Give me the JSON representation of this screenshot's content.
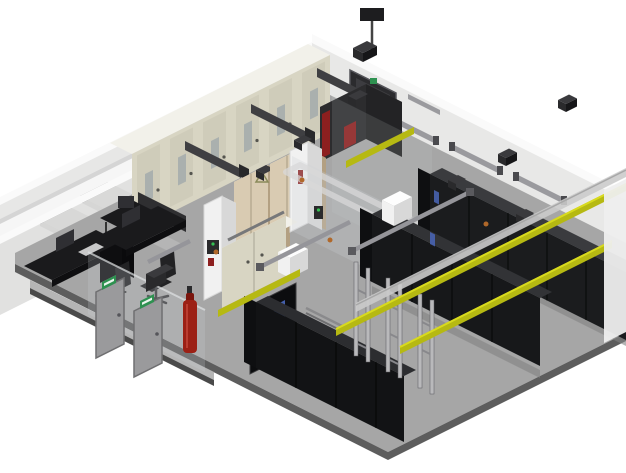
{
  "scene": {
    "type": "isometric-3d-render",
    "subject": "data-center-room-cutaway",
    "rooms": [
      "electrical-office-room",
      "server-hall"
    ]
  },
  "objects": {
    "electrical_cabinets": 6,
    "busbar_ducts": 4,
    "ups_units": 2,
    "server_rack_rows": 3,
    "open_frame_racks": 3,
    "desks": 2,
    "office_chairs": 2,
    "monitors": 3,
    "gray_doors": 2,
    "black_door_blue_windows": 1,
    "tall_dark_door": 1,
    "fire_suppression_cylinder": 1,
    "yellow_cable_trays": 4,
    "wall_light_fixtures": 4,
    "white_columns": 2,
    "white_roof_boxes": 2,
    "exterior_floor_tiles": 2,
    "exit_signs": 2,
    "smoke_detectors": 2
  },
  "colors": {
    "bg": "#ffffff",
    "exterior": "#f6f6f6",
    "tile": "#8f8f8f",
    "tile2": "#9a9a9a",
    "tile_side": "#6e6e6e",
    "wall_cap": "#fafafa",
    "wall_face": "#e7e7e6",
    "wall_face2": "#dededd",
    "wall_edge": "#d5d5d5",
    "floor": "#a6a6a6",
    "floor_rim": "#5d5d5d",
    "walkway": "#b5b5b5",
    "plinth": "#4a4a4a",
    "cabinet_top": "#f2f1ea",
    "cabinet_front": "#d8d5c3",
    "cabinet_door": "#cfccba",
    "cabinet_window": "#aab0ae",
    "busbar_dark": "#3f3f42",
    "busbar_dark2": "#2f2f31",
    "busbar_cap": "#28282a",
    "ups_top": "#efe8d2",
    "ups_front": "#d9cbb2",
    "ups_side": "#b3a082",
    "unit_front": "#2c2c2e",
    "unit_side": "#232325",
    "unit_top": "#434346",
    "red_accent": "#8d1f1f",
    "rack_front": "#1b1c1e",
    "rack_front2": "#17181a",
    "rack_front3": "#121315",
    "rack_top": "#3a3b3e",
    "rack_top2": "#323336",
    "rack_top3": "#2c2d30",
    "rack_side": "#0e0f11",
    "rail": "#b9b9bb",
    "tray_yellow": "#b6b912",
    "tray_yellow_hi": "#d8da1e",
    "tray_gray": "#cbcbcb",
    "pipe_gray": "#95959a",
    "white_box": "#fdfdfd",
    "white_box_side": "#d8d8d8",
    "glass": "#cdd2d5",
    "desk": "#1a1a1c",
    "chair": "#222224",
    "door_gray": "#9a9a9c",
    "exit_green": "#2e9150",
    "door_black": "#0c0d0f",
    "blue_window": "#4a66b8",
    "device_dark": "#2a2a2c",
    "orange_dot": "#b0682a",
    "light_bar": "#9a9a9e",
    "red_cylinder": "#9c2015"
  }
}
